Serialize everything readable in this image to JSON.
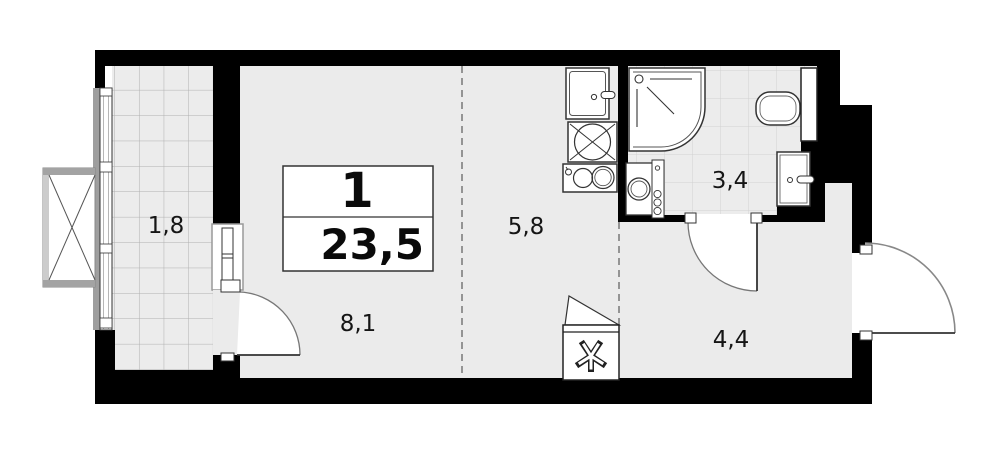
{
  "plan": {
    "type": "apartment-floor-plan",
    "title_box": {
      "rooms_count": "1",
      "total_area": "23,5"
    },
    "areas": [
      {
        "id": "balcony",
        "label": "1,8"
      },
      {
        "id": "living",
        "label": "8,1"
      },
      {
        "id": "kitchen",
        "label": "5,8"
      },
      {
        "id": "bathroom",
        "label": "3,4"
      },
      {
        "id": "hallway",
        "label": "4,4"
      }
    ],
    "fixtures": [
      "window-x-box",
      "balcony-glazing",
      "balcony-door",
      "kitchen-sink",
      "washing-machine-kitchen",
      "hob-2-burner",
      "shower-cabin",
      "toilet",
      "duct-shaft",
      "washbasin",
      "washing-machine-bath",
      "pipe-riser",
      "ventilation-shaft",
      "bathroom-door",
      "entrance-door"
    ],
    "colors": {
      "wall": "#000000",
      "floor": "#ebebeb",
      "tile_fill": "#ececec",
      "tile_line_balcony": "#b0b0b0",
      "tile_line_bath": "#d2d2d2",
      "outline": "#333333",
      "dashed_divider": "#777777",
      "frame_gray": "#9e9e9e"
    }
  }
}
